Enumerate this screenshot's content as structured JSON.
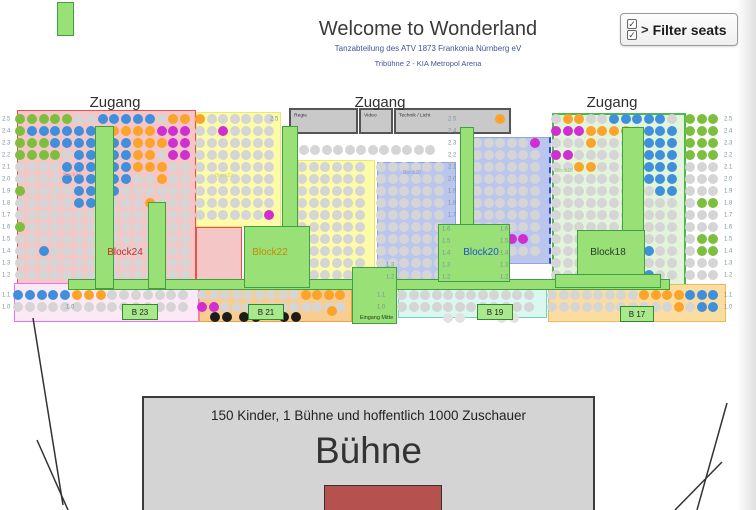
{
  "header": {
    "title": "Welcome to Wonderland",
    "subtitle1": "Tanzabteilung des ATV 1873 Frankonia Nürnberg eV",
    "subtitle2": "Tribühne 2 - KIA Metropol Arena",
    "filter_button_label": "Filter seats",
    "filter_chevron": ">",
    "checkbox_glyph": "✓"
  },
  "stage": {
    "line1": "150 Kinder, 1 Bühne und hoffentlich 1000 Zuschauer",
    "title": "Bühne"
  },
  "map": {
    "seat_colors": {
      ".": "#d5d5d5",
      "b": "#3f8fdc",
      "g": "#7cbf3e",
      "o": "#fba32a",
      "m": "#d02ed0",
      "k": "#1c1c1c",
      "w": "#e2e2e2"
    },
    "zugang_labels": [
      {
        "text": "Zugang",
        "x": 115,
        "y": 94
      },
      {
        "text": "Zugang",
        "x": 380,
        "y": 94
      },
      {
        "text": "Zugang",
        "x": 612,
        "y": 94
      }
    ],
    "regions": [
      {
        "name": "block24-area",
        "x": 17,
        "y": 110,
        "w": 179,
        "h": 179,
        "bg": "#f5c6c6",
        "bc": "#ef4e4e"
      },
      {
        "name": "block24-area-ext",
        "x": 196,
        "y": 227,
        "w": 46,
        "h": 62,
        "bg": "#f5c6c6",
        "bc": "#ef4e4e"
      },
      {
        "name": "block22-area-left",
        "x": 196,
        "y": 112,
        "w": 85,
        "h": 115,
        "bg": "#fbfba8",
        "bc": "#e8e872"
      },
      {
        "name": "block22-area-right",
        "x": 298,
        "y": 160,
        "w": 77,
        "h": 128,
        "bg": "#fbfba8",
        "bc": "#e8e872"
      },
      {
        "name": "block20-area-left",
        "x": 377,
        "y": 162,
        "w": 79,
        "h": 118,
        "bg": "#bac6ee",
        "bc": "#93a4dd"
      },
      {
        "name": "block20-area-right",
        "x": 473,
        "y": 137,
        "w": 78,
        "h": 127,
        "bg": "#bac6ee",
        "bc": "#93a4dd",
        "dashedRight": true
      },
      {
        "name": "block18-area",
        "x": 552,
        "y": 113,
        "w": 134,
        "h": 176,
        "bg": "#e2f4da",
        "bc": "#4db84d",
        "bw": 2
      },
      {
        "name": "b23-area",
        "x": 14,
        "y": 283,
        "w": 185,
        "h": 39,
        "bg": "#fce9f6",
        "bc": "#f06ef0"
      },
      {
        "name": "b21-area",
        "x": 199,
        "y": 284,
        "w": 153,
        "h": 38,
        "bg": "#f8cd92",
        "bc": "#eda33d"
      },
      {
        "name": "b19-area",
        "x": 398,
        "y": 284,
        "w": 149,
        "h": 34,
        "bg": "#daf7f0",
        "bc": "#6fd3c0"
      },
      {
        "name": "b17-area",
        "x": 548,
        "y": 284,
        "w": 178,
        "h": 38,
        "bg": "#fbdda2",
        "bc": "#e9bb55"
      }
    ],
    "gray_boxes": [
      {
        "label": "Regie",
        "x": 289,
        "y": 108,
        "w": 69,
        "h": 26
      },
      {
        "label": "Video",
        "x": 359,
        "y": 108,
        "w": 34,
        "h": 26
      },
      {
        "label": "Technik / Licht",
        "x": 394,
        "y": 108,
        "w": 117,
        "h": 26
      }
    ],
    "walkways": [
      {
        "name": "walkway-top-left-marker",
        "x": 57,
        "y": 2,
        "w": 17,
        "h": 34
      },
      {
        "name": "walkway-front",
        "x": 68,
        "y": 279,
        "w": 602,
        "h": 11
      },
      {
        "name": "stair-block24-1",
        "x": 95,
        "y": 126,
        "w": 19,
        "h": 163
      },
      {
        "name": "stair-block24-2",
        "x": 148,
        "y": 202,
        "w": 18,
        "h": 87
      },
      {
        "name": "stair-block22",
        "x": 282,
        "y": 126,
        "w": 16,
        "h": 101
      },
      {
        "name": "platform-block22",
        "x": 244,
        "y": 226,
        "w": 66,
        "h": 62
      },
      {
        "name": "stair-block20",
        "x": 460,
        "y": 127,
        "w": 14,
        "h": 98
      },
      {
        "name": "platform-block20",
        "x": 438,
        "y": 224,
        "w": 72,
        "h": 58
      },
      {
        "name": "stair-block18",
        "x": 622,
        "y": 127,
        "w": 22,
        "h": 104
      },
      {
        "name": "platform-block18",
        "x": 577,
        "y": 230,
        "w": 68,
        "h": 46
      },
      {
        "name": "platform-block18-base",
        "x": 555,
        "y": 274,
        "w": 106,
        "h": 14
      },
      {
        "name": "eingang-mitte",
        "x": 352,
        "y": 267,
        "w": 45,
        "h": 57,
        "label": "Eingang Mitte"
      }
    ],
    "entrance_boxes": [
      {
        "label": "B 23",
        "x": 122,
        "y": 304,
        "w": 36,
        "h": 16
      },
      {
        "label": "B 21",
        "x": 248,
        "y": 304,
        "w": 36,
        "h": 16
      },
      {
        "label": "B 19",
        "x": 477,
        "y": 304,
        "w": 36,
        "h": 16
      },
      {
        "label": "B 17",
        "x": 620,
        "y": 306,
        "w": 34,
        "h": 16
      }
    ],
    "block_labels": [
      {
        "text": "Block24",
        "x": 125,
        "y": 247,
        "color": "#dd2222",
        "size": 10
      },
      {
        "text": "Block22",
        "x": 270,
        "y": 247,
        "color": "#cc8800",
        "size": 10
      },
      {
        "text": "Block20",
        "x": 481,
        "y": 247,
        "color": "#2255cc",
        "size": 10
      },
      {
        "text": "Block18",
        "x": 608,
        "y": 247,
        "color": "#2a3a2a",
        "size": 10
      },
      {
        "text": "Block24",
        "x": 72,
        "y": 172,
        "color": "#e09999",
        "size": 5
      },
      {
        "text": "Block22",
        "x": 224,
        "y": 173,
        "color": "#d8d855",
        "size": 5
      },
      {
        "text": "Block20",
        "x": 412,
        "y": 170,
        "color": "#8898d0",
        "size": 5
      },
      {
        "text": "Block18",
        "x": 564,
        "y": 168,
        "color": "#9bc48b",
        "size": 5
      }
    ],
    "row_labels": [
      {
        "x": 2,
        "y": 119,
        "t": "2.5"
      },
      {
        "x": 2,
        "y": 131,
        "t": "2.4"
      },
      {
        "x": 2,
        "y": 143,
        "t": "2.3"
      },
      {
        "x": 2,
        "y": 155,
        "t": "2.2"
      },
      {
        "x": 2,
        "y": 167,
        "t": "2.1"
      },
      {
        "x": 2,
        "y": 179,
        "t": "2.0"
      },
      {
        "x": 2,
        "y": 191,
        "t": "1.9"
      },
      {
        "x": 2,
        "y": 203,
        "t": "1.8"
      },
      {
        "x": 2,
        "y": 215,
        "t": "1.7"
      },
      {
        "x": 2,
        "y": 227,
        "t": "1.6"
      },
      {
        "x": 2,
        "y": 239,
        "t": "1.5"
      },
      {
        "x": 2,
        "y": 251,
        "t": "1.4"
      },
      {
        "x": 2,
        "y": 263,
        "t": "1.3"
      },
      {
        "x": 2,
        "y": 275,
        "t": "1.2"
      },
      {
        "x": 2,
        "y": 295,
        "t": "1.1"
      },
      {
        "x": 2,
        "y": 307,
        "t": "1.0"
      },
      {
        "x": 724,
        "y": 119,
        "t": "2.5"
      },
      {
        "x": 724,
        "y": 131,
        "t": "2.4"
      },
      {
        "x": 724,
        "y": 143,
        "t": "2.3"
      },
      {
        "x": 724,
        "y": 155,
        "t": "2.2"
      },
      {
        "x": 724,
        "y": 167,
        "t": "2.1"
      },
      {
        "x": 724,
        "y": 179,
        "t": "2.0"
      },
      {
        "x": 724,
        "y": 191,
        "t": "1.9"
      },
      {
        "x": 724,
        "y": 203,
        "t": "1.8"
      },
      {
        "x": 724,
        "y": 215,
        "t": "1.7"
      },
      {
        "x": 724,
        "y": 227,
        "t": "1.6"
      },
      {
        "x": 724,
        "y": 239,
        "t": "1.5"
      },
      {
        "x": 724,
        "y": 251,
        "t": "1.4"
      },
      {
        "x": 724,
        "y": 263,
        "t": "1.3"
      },
      {
        "x": 724,
        "y": 275,
        "t": "1.2"
      },
      {
        "x": 724,
        "y": 295,
        "t": "1.1"
      },
      {
        "x": 724,
        "y": 307,
        "t": "1.0"
      },
      {
        "x": 448,
        "y": 119,
        "t": "2.5"
      },
      {
        "x": 448,
        "y": 131,
        "t": "2.4"
      },
      {
        "x": 448,
        "y": 143,
        "t": "2.3"
      },
      {
        "x": 448,
        "y": 155,
        "t": "2.2"
      },
      {
        "x": 448,
        "y": 167,
        "t": "2.1"
      },
      {
        "x": 448,
        "y": 179,
        "t": "2.0"
      },
      {
        "x": 448,
        "y": 191,
        "t": "1.9"
      },
      {
        "x": 448,
        "y": 203,
        "t": "1.8"
      },
      {
        "x": 448,
        "y": 215,
        "t": "1.7"
      },
      {
        "x": 442,
        "y": 229,
        "t": "1.6"
      },
      {
        "x": 442,
        "y": 241,
        "t": "1.5"
      },
      {
        "x": 442,
        "y": 253,
        "t": "1.4"
      },
      {
        "x": 442,
        "y": 265,
        "t": "1.3"
      },
      {
        "x": 442,
        "y": 277,
        "t": "1.2"
      },
      {
        "x": 500,
        "y": 229,
        "t": "1.6"
      },
      {
        "x": 500,
        "y": 241,
        "t": "1.5"
      },
      {
        "x": 500,
        "y": 253,
        "t": "1.4"
      },
      {
        "x": 500,
        "y": 265,
        "t": "1.3"
      },
      {
        "x": 500,
        "y": 277,
        "t": "1.2"
      },
      {
        "x": 386,
        "y": 265,
        "t": "1.3"
      },
      {
        "x": 386,
        "y": 277,
        "t": "1.2"
      },
      {
        "x": 377,
        "y": 295,
        "t": "1.1"
      },
      {
        "x": 377,
        "y": 307,
        "t": "1.0"
      },
      {
        "x": 270,
        "y": 119,
        "t": "2.5"
      },
      {
        "x": 66,
        "y": 307,
        "t": "1.0"
      }
    ],
    "seat_blocks": [
      {
        "name": "block24",
        "x0": 20,
        "y0": 119,
        "dx": 11.8,
        "dy": 12,
        "rows": [
          "ggggg..bbbbb.oo",
          "gbbbbbb.oooommm",
          "gggbbbb.bbooomm",
          "gggg.bb.bboo.mm",
          "....bbb.bbooo..",
          "....bbb.bb..o..",
          "g....bb.b......",
          ".....bb....o...",
          "...............",
          "g..............",
          "...............",
          "..b............",
          "...............",
          "..............."
        ]
      },
      {
        "name": "block22-left",
        "x0": 200,
        "y0": 119,
        "dx": 11.5,
        "dy": 12,
        "rows": [
          "o......",
          "..m....",
          ".......",
          ".......",
          ".......",
          ".......",
          ".......",
          ".......",
          "......m"
        ]
      },
      {
        "name": "block22-right",
        "x0": 302,
        "y0": 167,
        "dx": 11.5,
        "dy": 12,
        "rows": [
          "......",
          "......",
          "......",
          "......",
          "......",
          "......",
          "......",
          "......",
          "......",
          "g....."
        ]
      },
      {
        "name": "block20-left",
        "x0": 381,
        "y0": 167,
        "dx": 11.5,
        "dy": 12,
        "rows": [
          "......",
          "......",
          "......",
          "......",
          "......",
          "......",
          "......",
          "......",
          "......",
          "......"
        ]
      },
      {
        "name": "block20-right",
        "x0": 477,
        "y0": 143,
        "dx": 11.5,
        "dy": 12,
        "rows": [
          ".....m",
          "......",
          "......",
          "......",
          "......",
          "......",
          "......",
          "......",
          "...mm.",
          "......"
        ]
      },
      {
        "name": "block18",
        "x0": 556,
        "y0": 119,
        "dx": 11.6,
        "dy": 12,
        "rows": [
          ".oo..bbbbb.",
          "mmmoooo.bbb",
          "...o....bbb",
          "mm......bbb",
          "..oo....bbb",
          ".......bbbb",
          ".........bb",
          "...........",
          "...........",
          "...........",
          "...........",
          "........b..",
          "...........",
          "........b.."
        ]
      },
      {
        "name": "right-loose-seats",
        "x0": 690,
        "y0": 119,
        "dx": 11.5,
        "dy": 12,
        "rows": [
          "ggg",
          "ggg",
          "ggg",
          "ggg",
          "...",
          "...",
          "...",
          ".gg",
          "...",
          "...",
          ".gg",
          ".gg",
          "...",
          "..."
        ]
      },
      {
        "name": "mid-loose-row",
        "x0": 292,
        "y0": 150,
        "dx": 11.5,
        "dy": 12,
        "rows": [
          "............."
        ]
      },
      {
        "name": "loose-above-block20",
        "x0": 477,
        "y0": 119,
        "dx": 11.5,
        "dy": 12,
        "rows": [
          "  o"
        ]
      },
      {
        "name": "b23-rows",
        "x0": 18,
        "y0": 295,
        "dx": 11.8,
        "dy": 12,
        "rows": [
          "bbbbbooo.......",
          "..............."
        ]
      },
      {
        "name": "b21-rows",
        "x0": 202,
        "y0": 295,
        "dx": 11.5,
        "dy": 12,
        "rows": [
          ".........oooo",
          "mm..........."
        ]
      },
      {
        "name": "b19-rows",
        "x0": 402,
        "y0": 295,
        "dx": 11.5,
        "dy": 12,
        "rows": [
          "............",
          "............"
        ]
      },
      {
        "name": "b17-rows",
        "x0": 552,
        "y0": 295,
        "dx": 11.5,
        "dy": 12,
        "rows": [
          "........oooobbb",
          "...........o.bb"
        ]
      }
    ],
    "free_seats": [
      {
        "x": 215,
        "y": 317,
        "c": "k"
      },
      {
        "x": 227,
        "y": 317,
        "c": "k"
      },
      {
        "x": 244,
        "y": 317,
        "c": "k"
      },
      {
        "x": 256,
        "y": 317,
        "c": "k"
      },
      {
        "x": 284,
        "y": 317,
        "c": "k"
      },
      {
        "x": 296,
        "y": 317,
        "c": "k"
      },
      {
        "x": 448,
        "y": 318,
        "c": "w"
      },
      {
        "x": 460,
        "y": 318,
        "c": "w"
      },
      {
        "x": 502,
        "y": 318,
        "c": "w"
      },
      {
        "x": 514,
        "y": 318,
        "c": "w"
      },
      {
        "x": 332,
        "y": 311,
        "c": "o"
      },
      {
        "x": 312,
        "y": 285,
        "c": "g"
      }
    ],
    "lines": [
      {
        "x1": 33,
        "y1": 318,
        "x2": 63,
        "y2": 505
      },
      {
        "x1": 37,
        "y1": 440,
        "x2": 68,
        "y2": 510
      },
      {
        "x1": 697,
        "y1": 510,
        "x2": 727,
        "y2": 403
      },
      {
        "x1": 675,
        "y1": 510,
        "x2": 722,
        "y2": 462
      }
    ]
  }
}
